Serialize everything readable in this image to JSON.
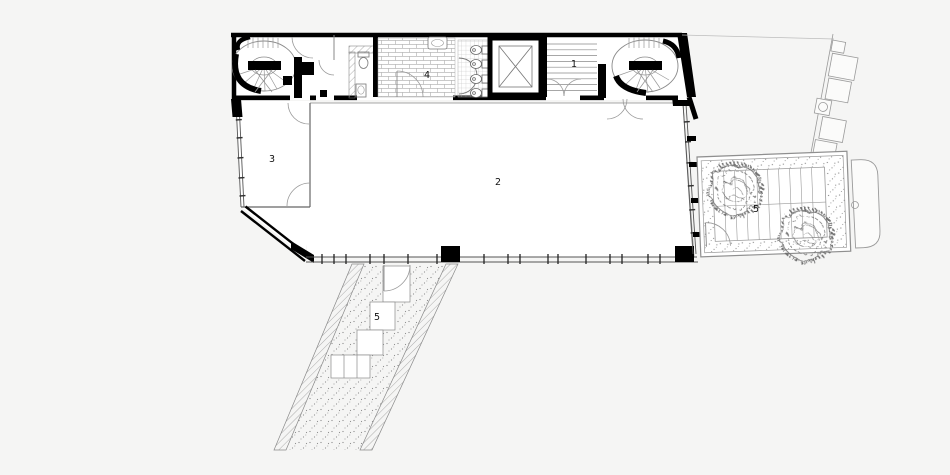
{
  "drawing": {
    "kind": "architectural floor plan",
    "labels": {
      "straight_stair": "1",
      "main_hall": "2",
      "front_room": "3",
      "bathroom": "4",
      "roof_terrace": "5",
      "entry_ramp": "5"
    },
    "colors": {
      "background": "#f5f5f4",
      "paper": "#ffffff",
      "wall": "#000000",
      "line_dark": "#555555",
      "line_light": "#9a9a9a"
    }
  }
}
